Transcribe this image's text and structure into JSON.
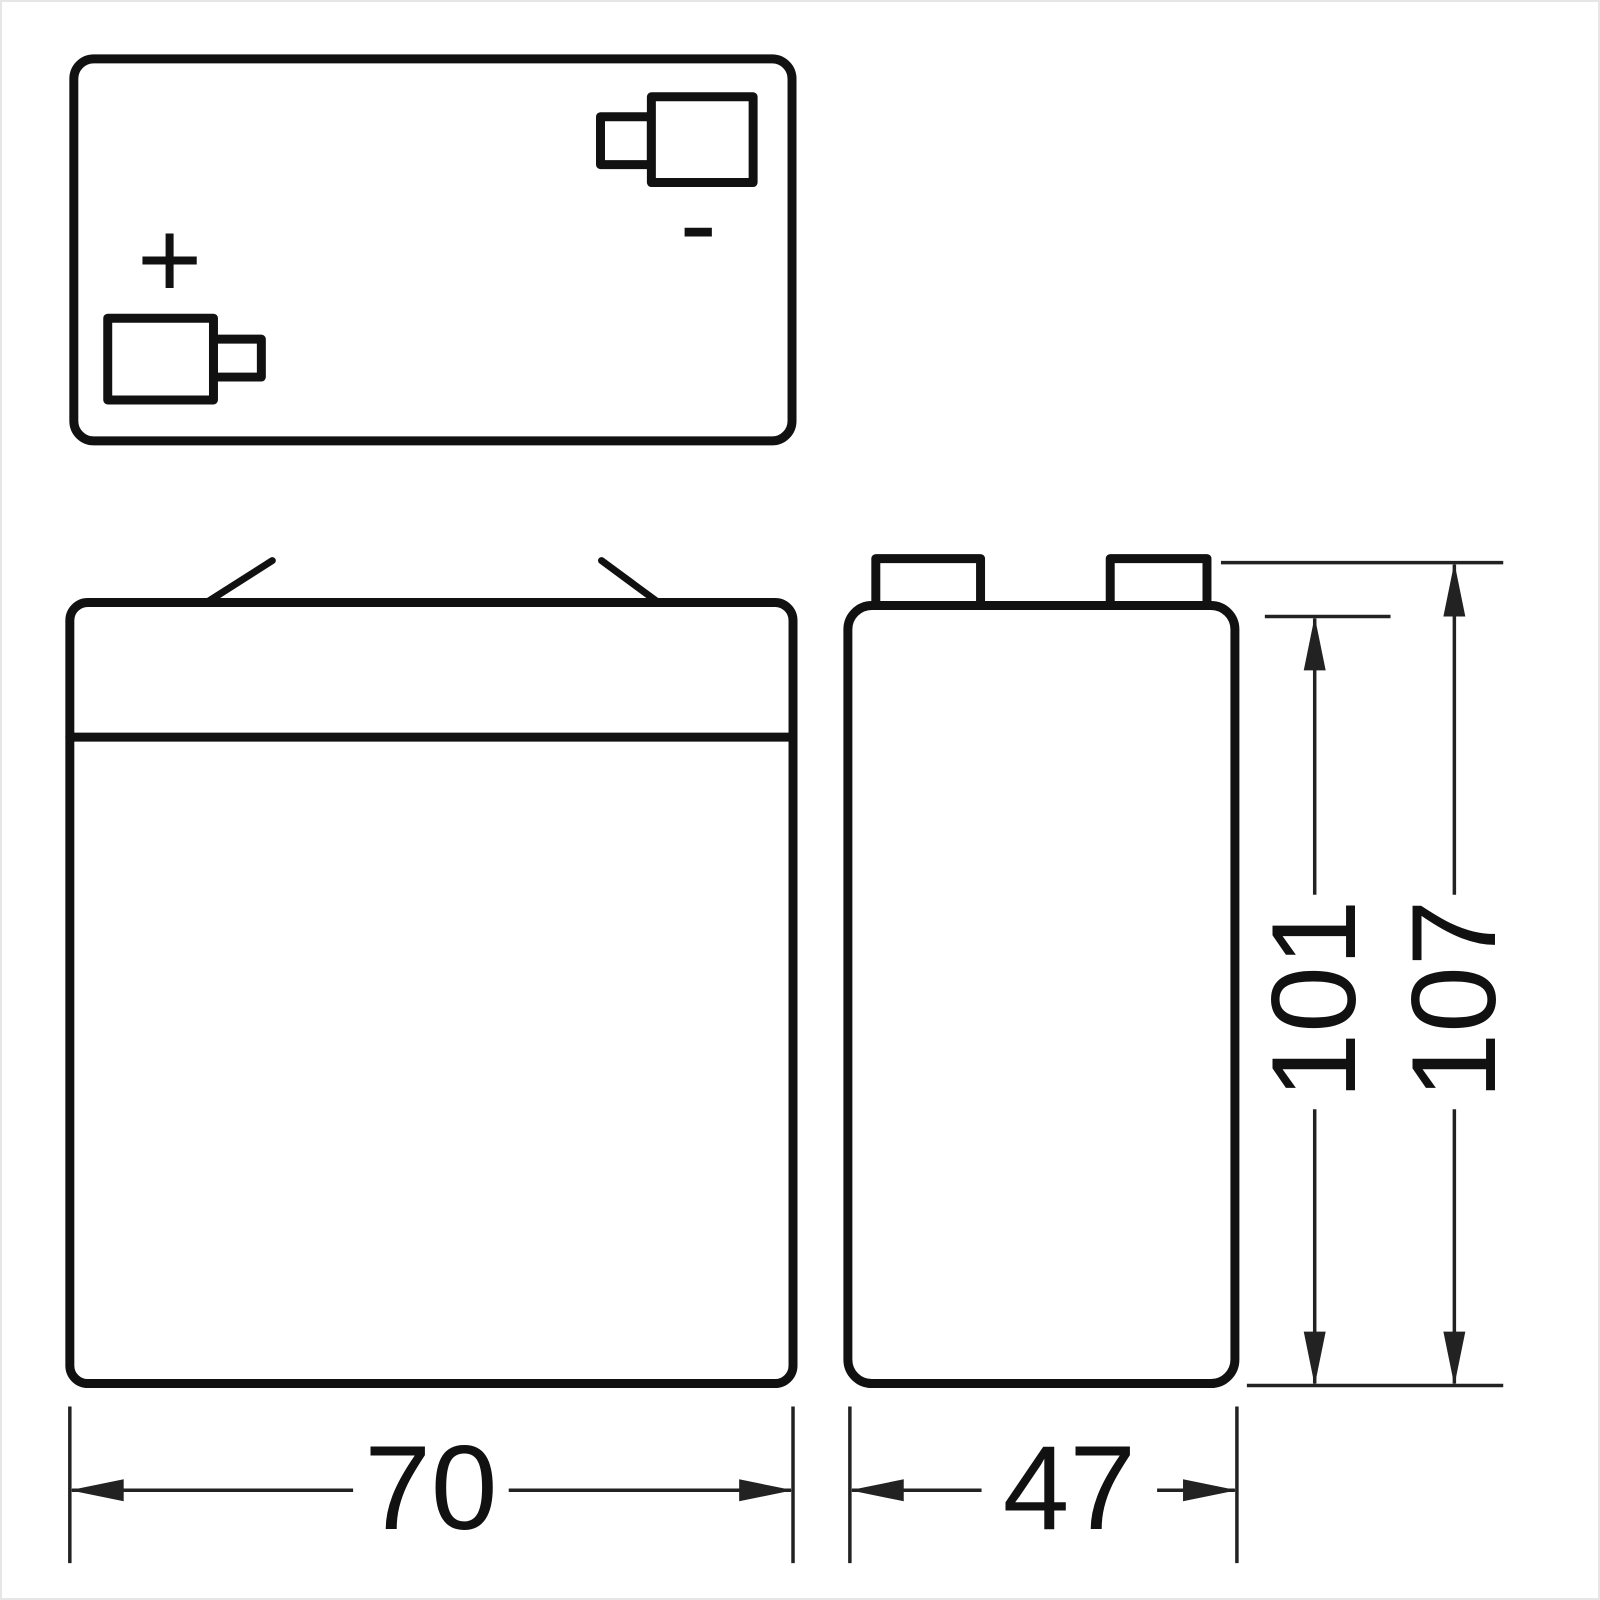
{
  "figure": {
    "kind": "battery-dimension-drawing",
    "background_color": "#ffffff",
    "line_color": "#111111",
    "dimension_line_color": "#222222"
  },
  "top_view": {
    "positive_symbol": "+",
    "negative_symbol": "-"
  },
  "dimensions": {
    "front_width": "70",
    "side_width": "47",
    "body_height": "101",
    "overall_height": "107"
  }
}
